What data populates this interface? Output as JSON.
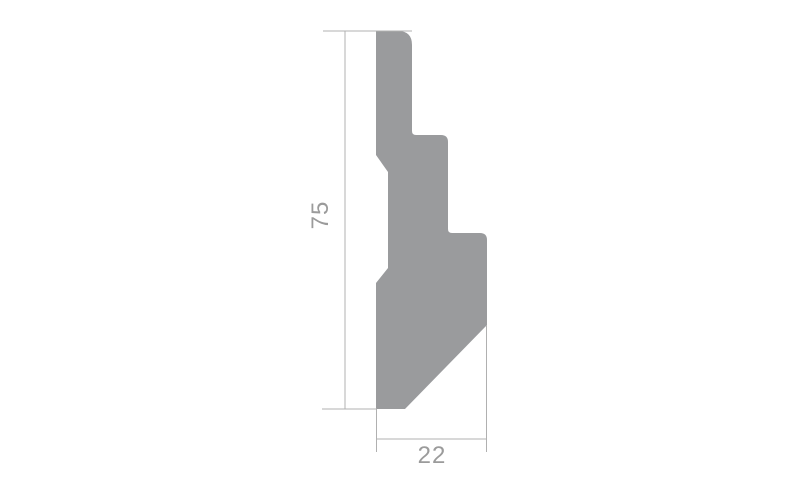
{
  "dimensions": {
    "height": "75",
    "width": "22"
  },
  "profile": {
    "path": "M 376 31 L 398 31 Q 412 31 412 45 L 412 131 Q 412 135 416 135 L 441 135 Q 448 135 448 142 L 448 229 Q 448 233 452 233 L 480 233 Q 487 233 487 240 L 487 325 L 405 409 L 376 409 L 376 283 L 388 268 L 388 172 L 376 155 Z"
  },
  "colors": {
    "profile_fill": "#9a9b9d",
    "dimension_line": "#b0b0b0",
    "label_text": "#9b9b9b",
    "background": "#ffffff"
  }
}
